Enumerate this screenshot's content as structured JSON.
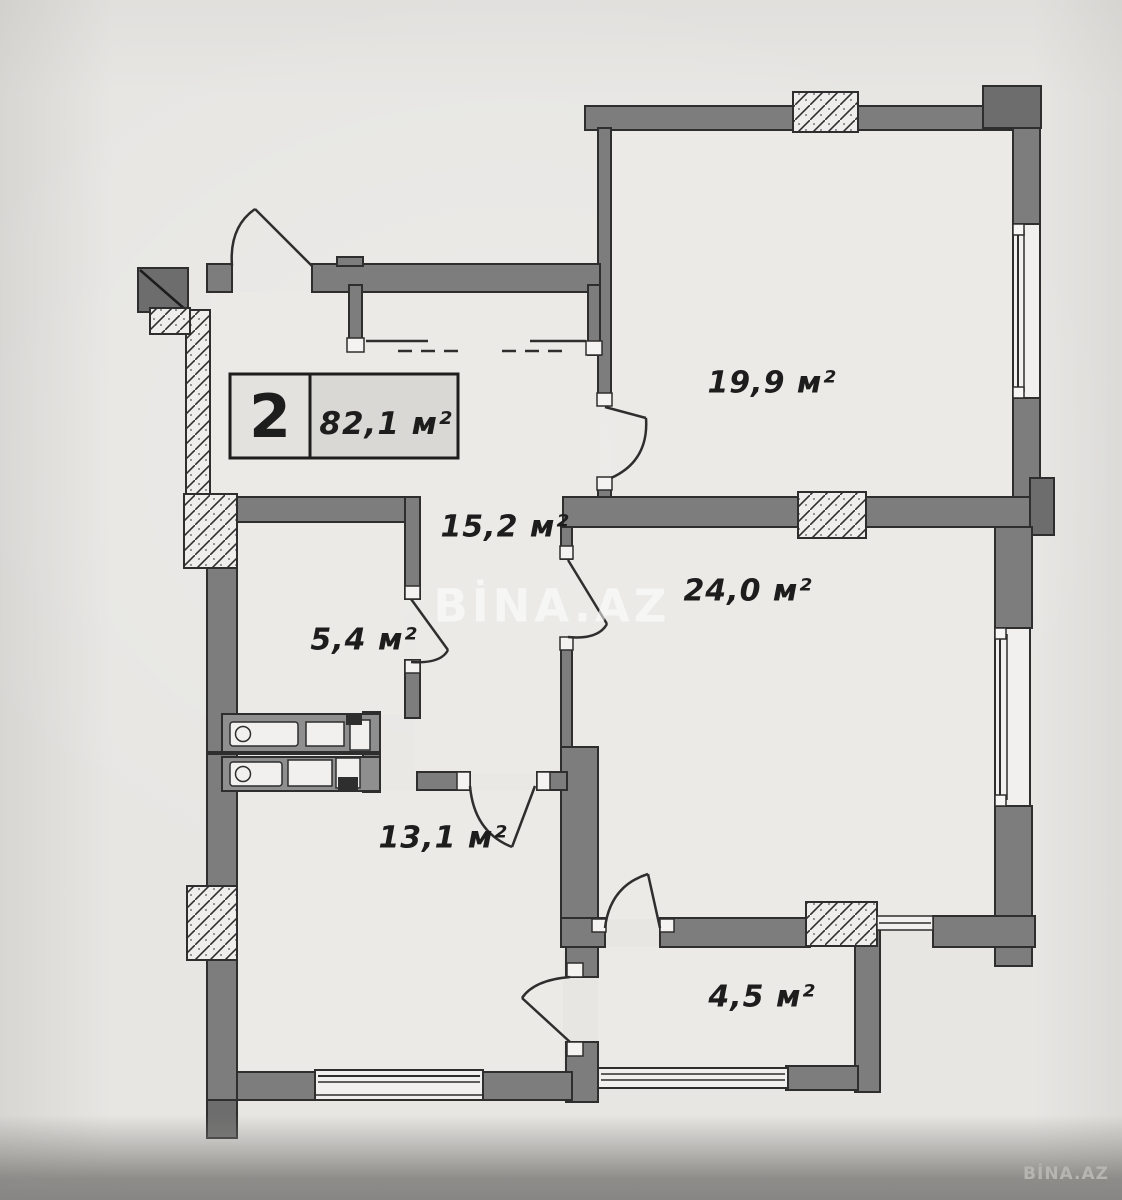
{
  "floor_plan": {
    "unit_box": {
      "number": "2",
      "total_area": "82,1 м²"
    },
    "rooms": [
      {
        "name": "living-room",
        "area_label": "19,9 м²"
      },
      {
        "name": "hallway",
        "area_label": "15,2 м²"
      },
      {
        "name": "bedroom",
        "area_label": "24,0 м²"
      },
      {
        "name": "bathroom",
        "area_label": "5,4 м²"
      },
      {
        "name": "kitchen",
        "area_label": "13,1 м²"
      },
      {
        "name": "balcony",
        "area_label": "4,5 м²"
      }
    ],
    "watermarks": {
      "center": "BİNA.AZ",
      "corner": "BİNA.AZ"
    },
    "colors": {
      "paper": "#e7e6e3",
      "room_fill": "#ebeae7",
      "wall": "#7d7d7d",
      "wall_dark": "#6d6d6d",
      "outline": "#2e2e2e",
      "band": "#878684",
      "counter": "#8f8f8f"
    }
  }
}
